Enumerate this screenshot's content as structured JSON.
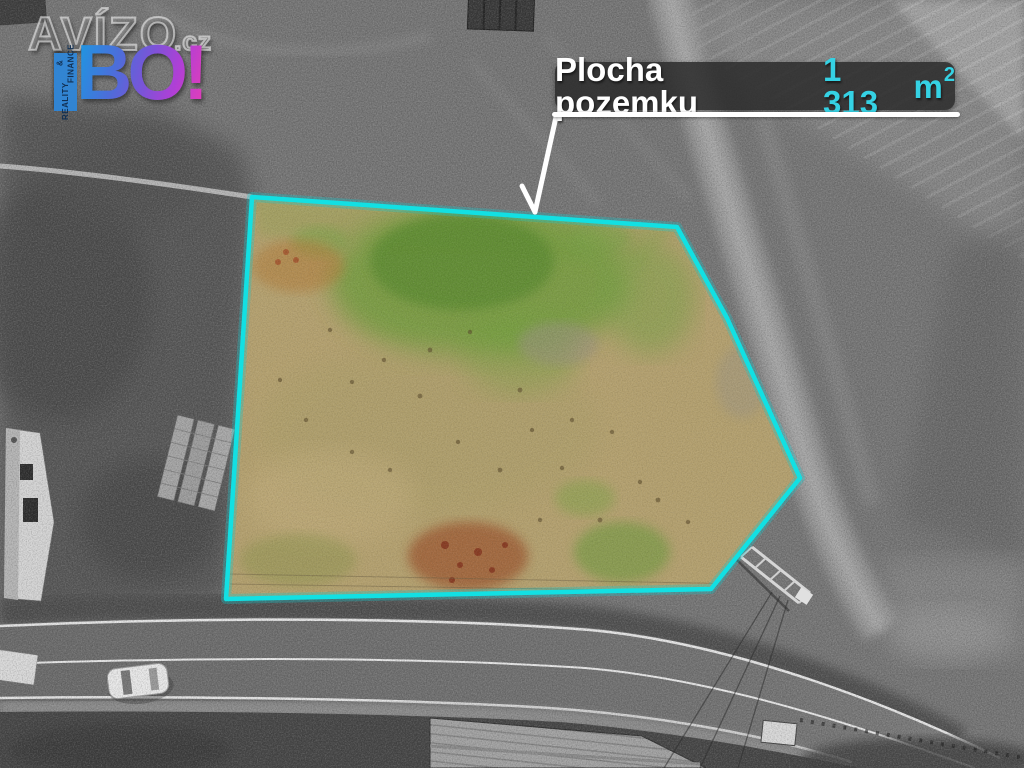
{
  "watermark": {
    "brand": "AVÍZO",
    "brand_tld": ".cz",
    "logo_text": "BO!",
    "logo_vertical_line1": "REALITY",
    "logo_vertical_line2": "& FINANCE",
    "logo_gradient_colors": [
      "#1d96e6",
      "#7d52dd",
      "#e23cc0"
    ],
    "tab_color": "#2f86d8"
  },
  "callout": {
    "label": "Plocha pozemku",
    "area_value": "1 313",
    "area_unit": "m",
    "area_exponent": "2",
    "box_color": "#2a2a2a",
    "label_color": "#ffffff",
    "value_color": "#35d2e4",
    "leader_points": "556,117 535,212",
    "arrowhead_points": "522,186 535,212"
  },
  "parcel": {
    "outline_points": "252,197 677,227 727,318 800,478 711,589 226,599",
    "outline_color": "#12e0e3"
  }
}
